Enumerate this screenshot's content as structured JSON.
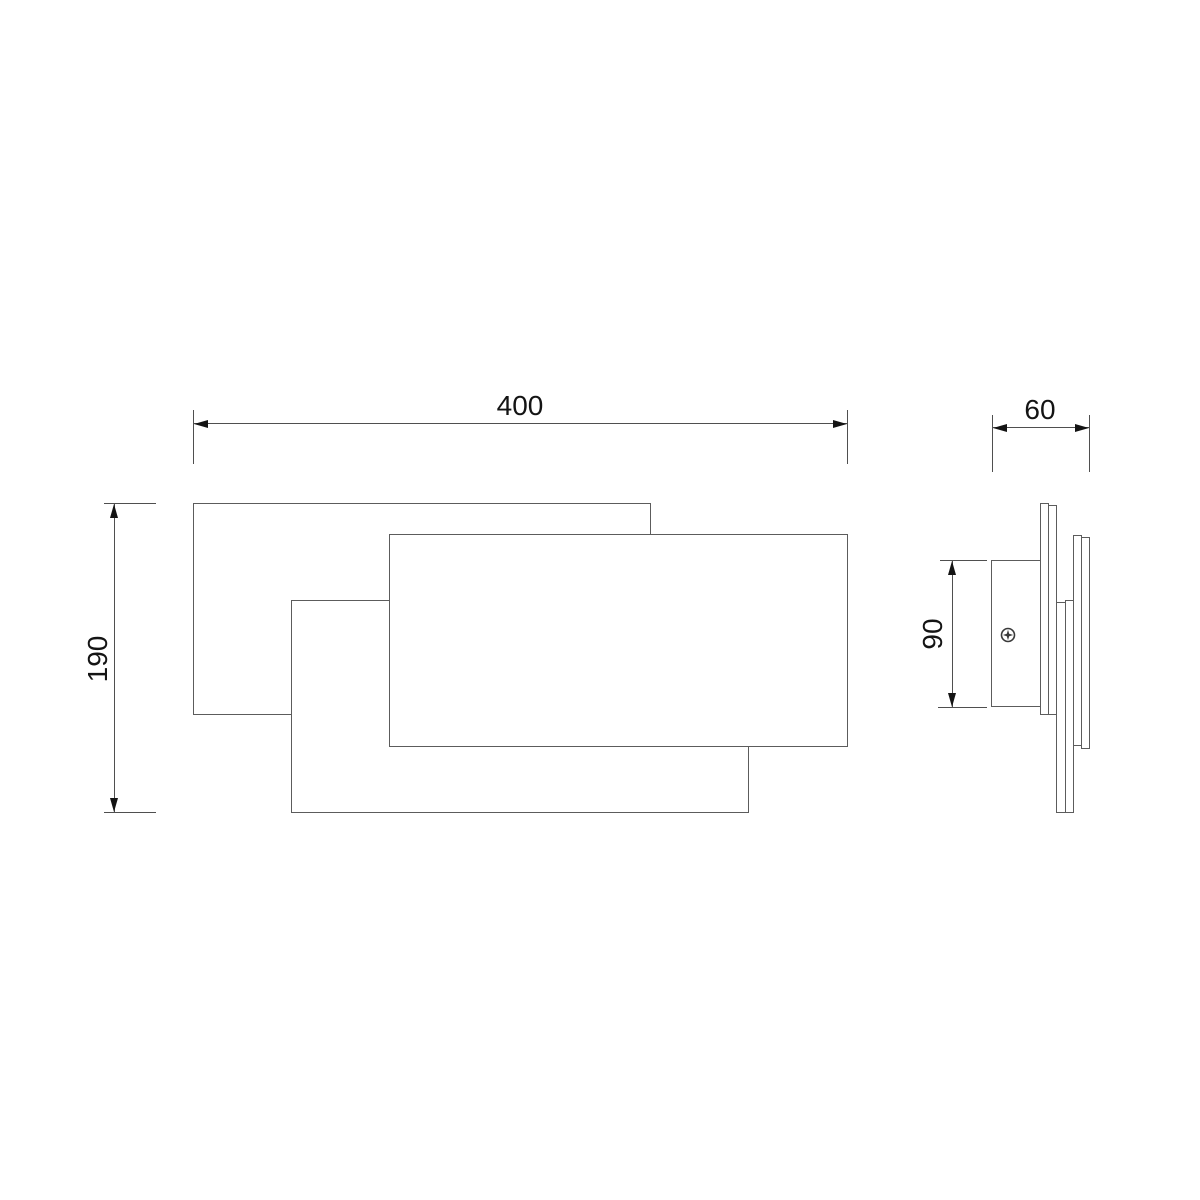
{
  "drawing": {
    "colors": {
      "bg": "#ffffff",
      "line": "#5c5c5c",
      "dim": "#4f4f4f",
      "text": "#141414"
    },
    "front_view": {
      "width_dim": "400",
      "height_dim": "190"
    },
    "side_view": {
      "depth_dim": "60",
      "bracket_height_dim": "90"
    },
    "icons": {
      "screw": "phillips-screw-head-icon"
    }
  }
}
